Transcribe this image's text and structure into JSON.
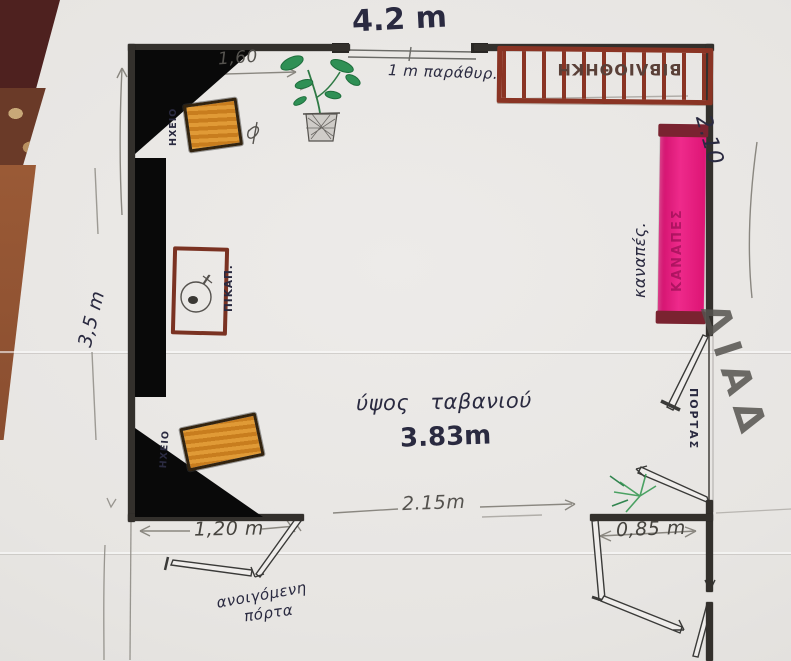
{
  "drawing_title": "hand-drawn room floor plan",
  "dimensions": {
    "top_width": "4.2 m",
    "left_offset": "1,60",
    "window": "1 m παράθυρ.",
    "right_height": "2.10",
    "left_height": "3,5 m",
    "bottom_left": "1,20 m",
    "bottom_middle": "2.15m",
    "bottom_right": "0,85 m",
    "ceiling_label": "ύψος ταβανιού",
    "ceiling_value": "3.83m"
  },
  "labels": {
    "bookshelf": "ΒΙΒΛΙΟΘΗΚΗ",
    "sofa": "καναπές.",
    "sofa_inner": "ΚΑΝΑΠΕΣ",
    "speaker_top": "ΗΧΕΙΟ",
    "speaker_bottom": "ΗΧΕΙΟ",
    "turntable": "ΠΙΚΑΠ.",
    "door_right": "ΠΟΡΤΑΣ",
    "door_bottom_line1": "ανοιγόμενη",
    "door_bottom_line2": "πόρτα",
    "corridor": "ΔΙΑΔ"
  },
  "colors": {
    "wall": "#33302c",
    "marker_black": "#090909",
    "sofa_magenta": "#e81c7e",
    "sofa_cap": "#7a2330",
    "speaker_orange": "#d08a28",
    "bookshelf_brown": "#8a3424",
    "plant_green": "#2e8b50",
    "ink": "#2a2a40",
    "pencil": "#55534f"
  }
}
